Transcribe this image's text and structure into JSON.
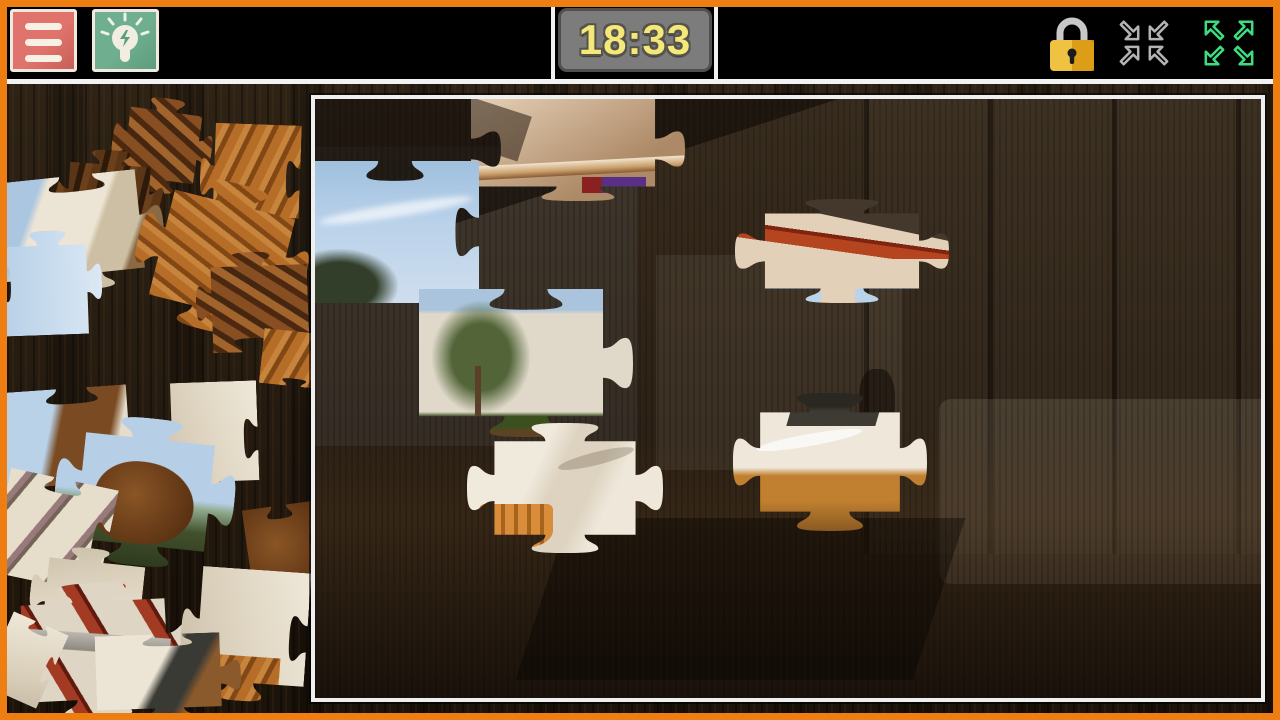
{
  "app": {
    "name": "Jigsaw Puzzle"
  },
  "toolbar": {
    "menu_button": {
      "icon": "hamburger-icon"
    },
    "hint_button": {
      "icon": "lightbulb-icon"
    },
    "timer": {
      "value": "18:33"
    },
    "lock_button": {
      "icon": "padlock-icon",
      "state": "locked"
    },
    "shrink_button": {
      "icon": "arrows-inward-icon"
    },
    "fullscreen_button": {
      "icon": "arrows-outward-icon"
    }
  },
  "board": {
    "state": "partially-completed",
    "image_subject": "living room with wooden beams, garden view, white sofas"
  },
  "tray": {
    "state": "loose pieces scattered on wood background"
  },
  "colors": {
    "frame_orange": "#EE7D12",
    "topbar_bg": "#000000",
    "menu_red": "#DB6E66",
    "hint_green": "#6BA88B",
    "timer_bg": "#7C7C7C",
    "timer_border": "#4F4F4F",
    "timer_text": "#F5E87A",
    "lock_gold": "#EDB52B",
    "arrows_gray": "#B3B3B3",
    "arrows_green": "#3FDC7F",
    "board_border": "#EFEFEF"
  }
}
